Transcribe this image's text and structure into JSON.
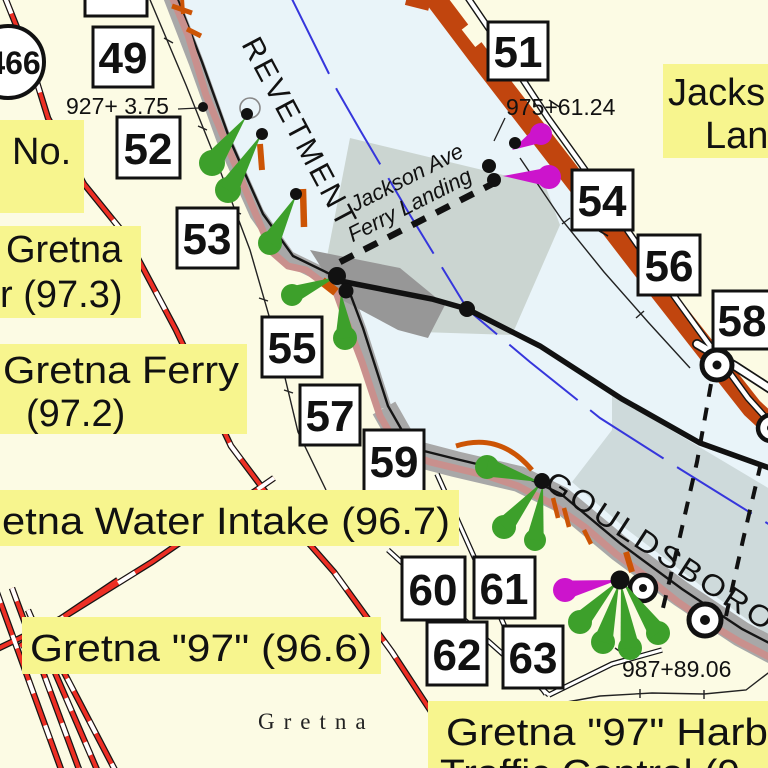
{
  "map": {
    "route_shield": "466",
    "revetment_text": "REVETMENT",
    "gouldsboro_text": "GOULDSBORO",
    "town_name": "Gretna",
    "ferry_route_label": {
      "line1": "Jackson Ave",
      "line2": "Ferry Landing"
    },
    "stations": {
      "s927": "927+ 3.75",
      "s975": "975+61.24",
      "s987": "987+89.06"
    },
    "mile_boxes": [
      {
        "label": "49"
      },
      {
        "label": "51"
      },
      {
        "label": "52"
      },
      {
        "label": "53"
      },
      {
        "label": "54"
      },
      {
        "label": "55"
      },
      {
        "label": "56"
      },
      {
        "label": "57"
      },
      {
        "label": "58"
      },
      {
        "label": "59"
      },
      {
        "label": "60"
      },
      {
        "label": "61"
      },
      {
        "label": "62"
      },
      {
        "label": "63"
      }
    ],
    "labels": {
      "no": "No.",
      "jackson_landing": {
        "line1": "Jacks",
        "line2": "Lan"
      },
      "gretna_upper": {
        "line1": "Gretna",
        "line2": "r (97.3)"
      },
      "gretna_ferry": {
        "line1": "Gretna Ferry",
        "line2": "(97.2)"
      },
      "water_intake": "etna Water Intake (96.7)",
      "gretna_97": "Gretna \"97\" (96.6)",
      "harbor": {
        "line1": "Gretna \"97\" Harb",
        "line2": "Traffic Control (9"
      }
    },
    "colors": {
      "land": "#FCFBE4",
      "water": "#E9F4F9",
      "label_bg": "#F7F58E",
      "bank_orange": "#C1450E",
      "orange_mark": "#CC5405",
      "bank_mauve": "#C9908D",
      "bank_gray": "#A8A8A8",
      "light_green": "#3DA02B",
      "light_magenta": "#CC14CC",
      "sailing_blue": "#3636DC",
      "road_red": "#ED2F24"
    }
  }
}
